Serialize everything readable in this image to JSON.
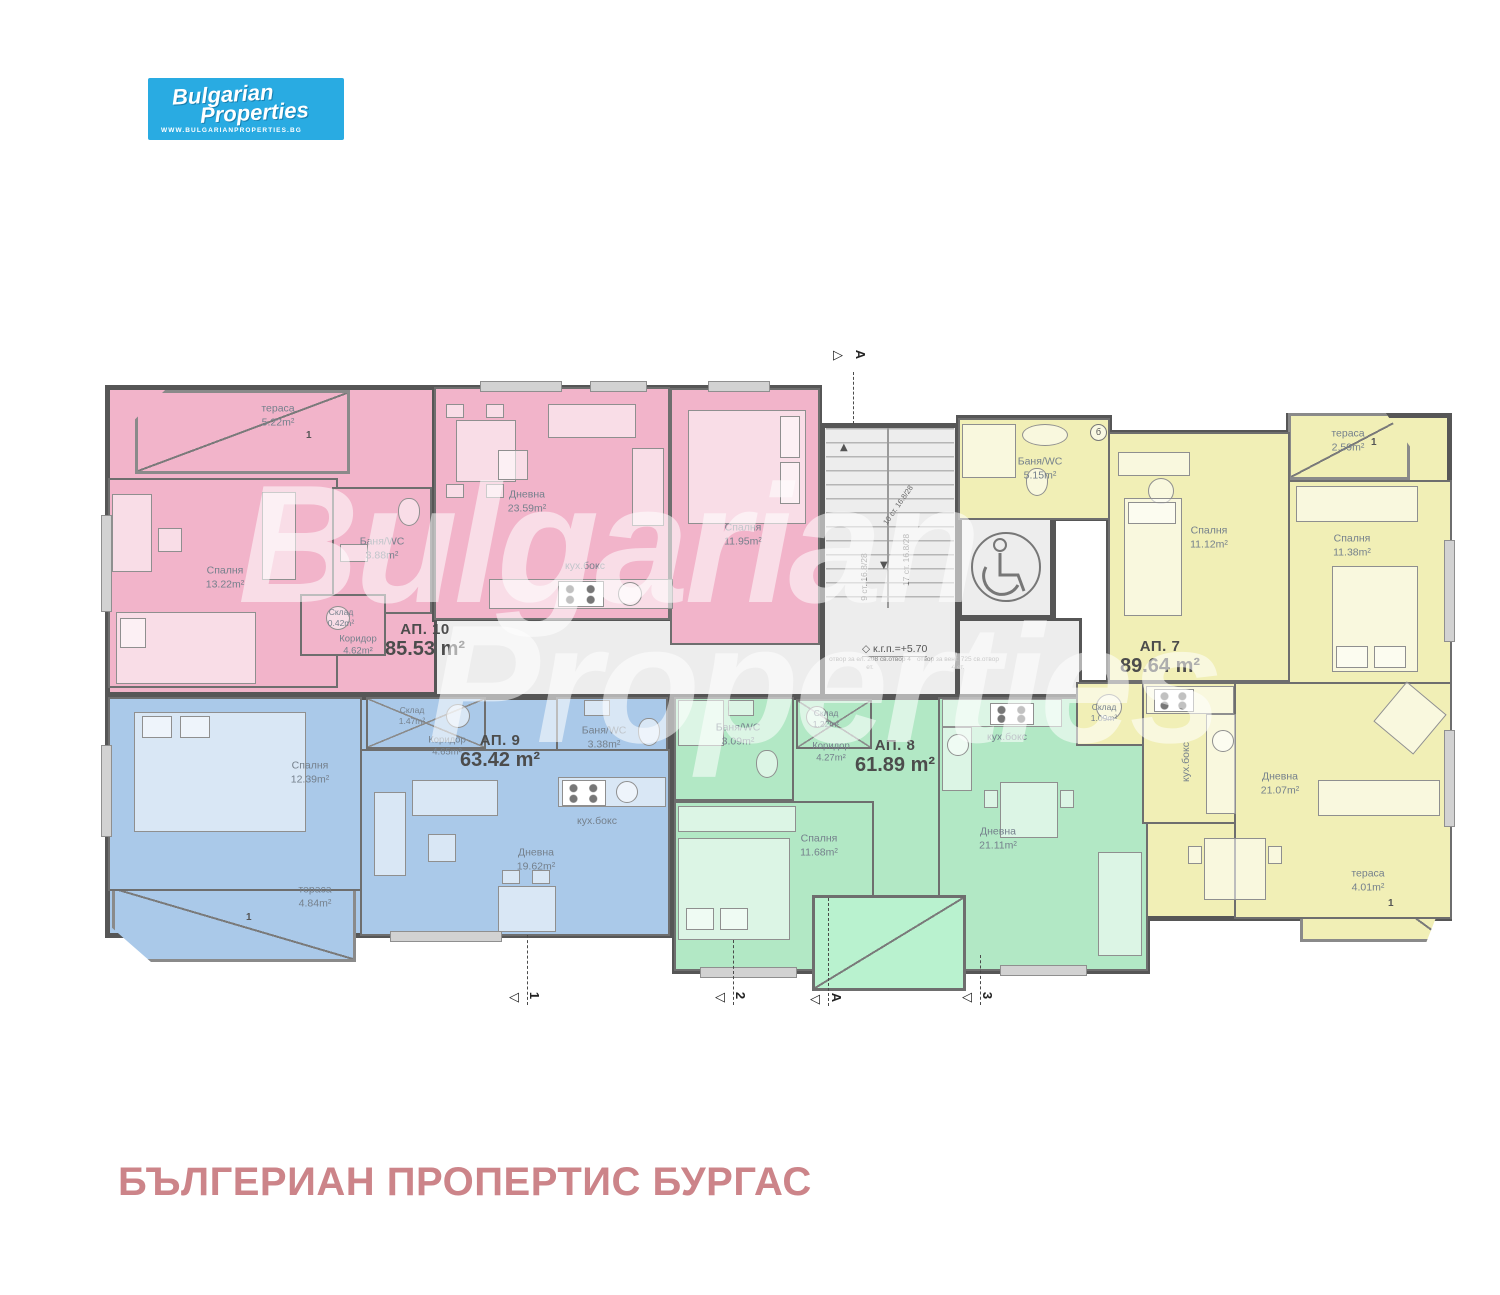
{
  "logo": {
    "brand_top": "Bulgarian",
    "brand_bottom": "Properties",
    "website": "WWW.BULGARIANPROPERTIES.BG"
  },
  "watermark": {
    "line1": "Bulgarian",
    "line2": "Properties"
  },
  "footer": {
    "title": "БЪЛГЕРИАН ПРОПЕРТИС БУРГАС"
  },
  "colors": {
    "logo_bg": "#29abe2",
    "ap10_pink": "#f2b4ca",
    "ap9_blue": "#aac9e9",
    "ap8_green": "#b2e8c5",
    "ap7_yellow": "#f1efb6",
    "core_gray": "#ededed",
    "walls": "#565656",
    "footer_text": "#cc8489"
  },
  "apartments": [
    {
      "name": "АП. 10",
      "area": "85.53 m²",
      "color": "#f2b4ca",
      "rooms": [
        {
          "name": "тераса",
          "area": "5.22m²"
        },
        {
          "name": "Спалня",
          "area": "13.22m²"
        },
        {
          "name": "Баня/WC",
          "area": "3.88m²"
        },
        {
          "name": "Склад",
          "area": "0.42m²"
        },
        {
          "name": "Коридор",
          "area": "4.62m²"
        },
        {
          "name": "Дневна",
          "area": "23.59m²"
        },
        {
          "name": "кух.бокс",
          "area": ""
        },
        {
          "name": "Спалня",
          "area": "11.95m²"
        }
      ]
    },
    {
      "name": "АП. 9",
      "area": "63.42 m²",
      "color": "#aac9e9",
      "rooms": [
        {
          "name": "Спалня",
          "area": "12.39m²"
        },
        {
          "name": "Склад",
          "area": "1.47m²"
        },
        {
          "name": "Коридор",
          "area": "4.65m²"
        },
        {
          "name": "Баня/WC",
          "area": "3.38m²"
        },
        {
          "name": "кух.бокс",
          "area": ""
        },
        {
          "name": "Дневна",
          "area": "19.62m²"
        },
        {
          "name": "тераса",
          "area": "4.84m²"
        }
      ]
    },
    {
      "name": "АП. 8",
      "area": "61.89 m²",
      "color": "#b2e8c5",
      "rooms": [
        {
          "name": "Баня/WC",
          "area": "3.09m²"
        },
        {
          "name": "Склад",
          "area": "1.22m²"
        },
        {
          "name": "Коридор",
          "area": "4.27m²"
        },
        {
          "name": "Спалня",
          "area": "11.68m²"
        },
        {
          "name": "кух.бокс",
          "area": ""
        },
        {
          "name": "Дневна",
          "area": "21.11m²"
        }
      ]
    },
    {
      "name": "АП. 7",
      "area": "89.64 m²",
      "color": "#f1efb6",
      "rooms": [
        {
          "name": "Баня/WC",
          "area": "5.15m²"
        },
        {
          "name": "Спалня",
          "area": "11.12m²"
        },
        {
          "name": "тераса",
          "area": "2.59m²"
        },
        {
          "name": "Спалня",
          "area": "11.38m²"
        },
        {
          "name": "Склад",
          "area": "1.09m²"
        },
        {
          "name": "кух.бокс",
          "area": ""
        },
        {
          "name": "Дневна",
          "area": "21.07m²"
        },
        {
          "name": "тераса",
          "area": "4.01m²"
        }
      ]
    }
  ],
  "core": {
    "stairs_flight_a": "9 ст. 16.8/28",
    "stairs_flight_b": "17 ст. 16.8/28",
    "stairs_flight_c": "10 ст. 16.8/28",
    "elevation_mark": "к.г.п.=+5.70",
    "note_left": "отвор за ел. 208 св.отвор 4 ет.",
    "note_right": "отвор за вент. 725 св.отвор 4 ет.",
    "detail_bubble": "б"
  },
  "section_markers": {
    "top": "А",
    "b1": "1",
    "b2": "2",
    "b3": "А",
    "b4": "3",
    "terrace_door_mark": "1"
  }
}
